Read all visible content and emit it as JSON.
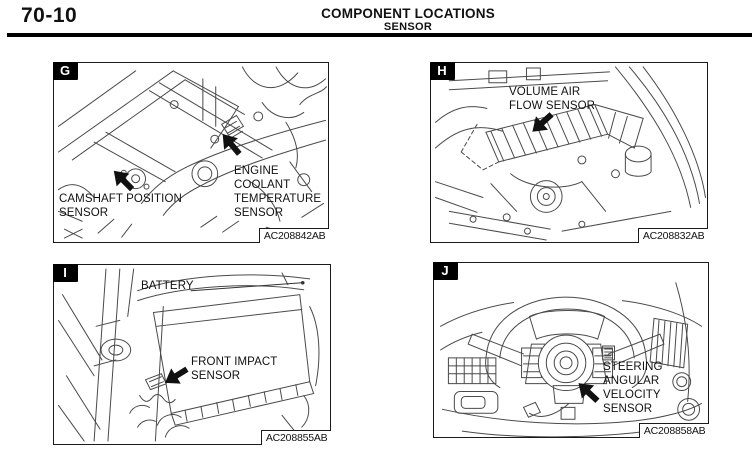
{
  "header": {
    "page_number": "70-10",
    "title": "COMPONENT LOCATIONS",
    "subtitle": "SENSOR"
  },
  "panels": [
    {
      "letter": "G",
      "code": "AC208842AB",
      "labels": [
        {
          "text": "CAMSHAFT POSITION\nSENSOR"
        },
        {
          "text": "ENGINE\nCOOLANT\nTEMPERATURE\nSENSOR"
        }
      ]
    },
    {
      "letter": "H",
      "code": "AC208832AB",
      "labels": [
        {
          "text": "VOLUME AIR\nFLOW SENSOR"
        }
      ]
    },
    {
      "letter": "I",
      "code": "AC208855AB",
      "labels": [
        {
          "text": "BATTERY"
        },
        {
          "text": "FRONT IMPACT\nSENSOR"
        }
      ]
    },
    {
      "letter": "J",
      "code": "AC208858AB",
      "labels": [
        {
          "text": "STEERING\nANGULAR\nVELOCITY\nSENSOR"
        }
      ]
    }
  ],
  "icons": {
    "pointer_arrow": "solid black pointer arrow"
  },
  "colors": {
    "ink": "#111111",
    "line_art": "#4a4a4a",
    "badge_bg": "#000000",
    "badge_fg": "#ffffff",
    "page_bg": "#ffffff"
  }
}
